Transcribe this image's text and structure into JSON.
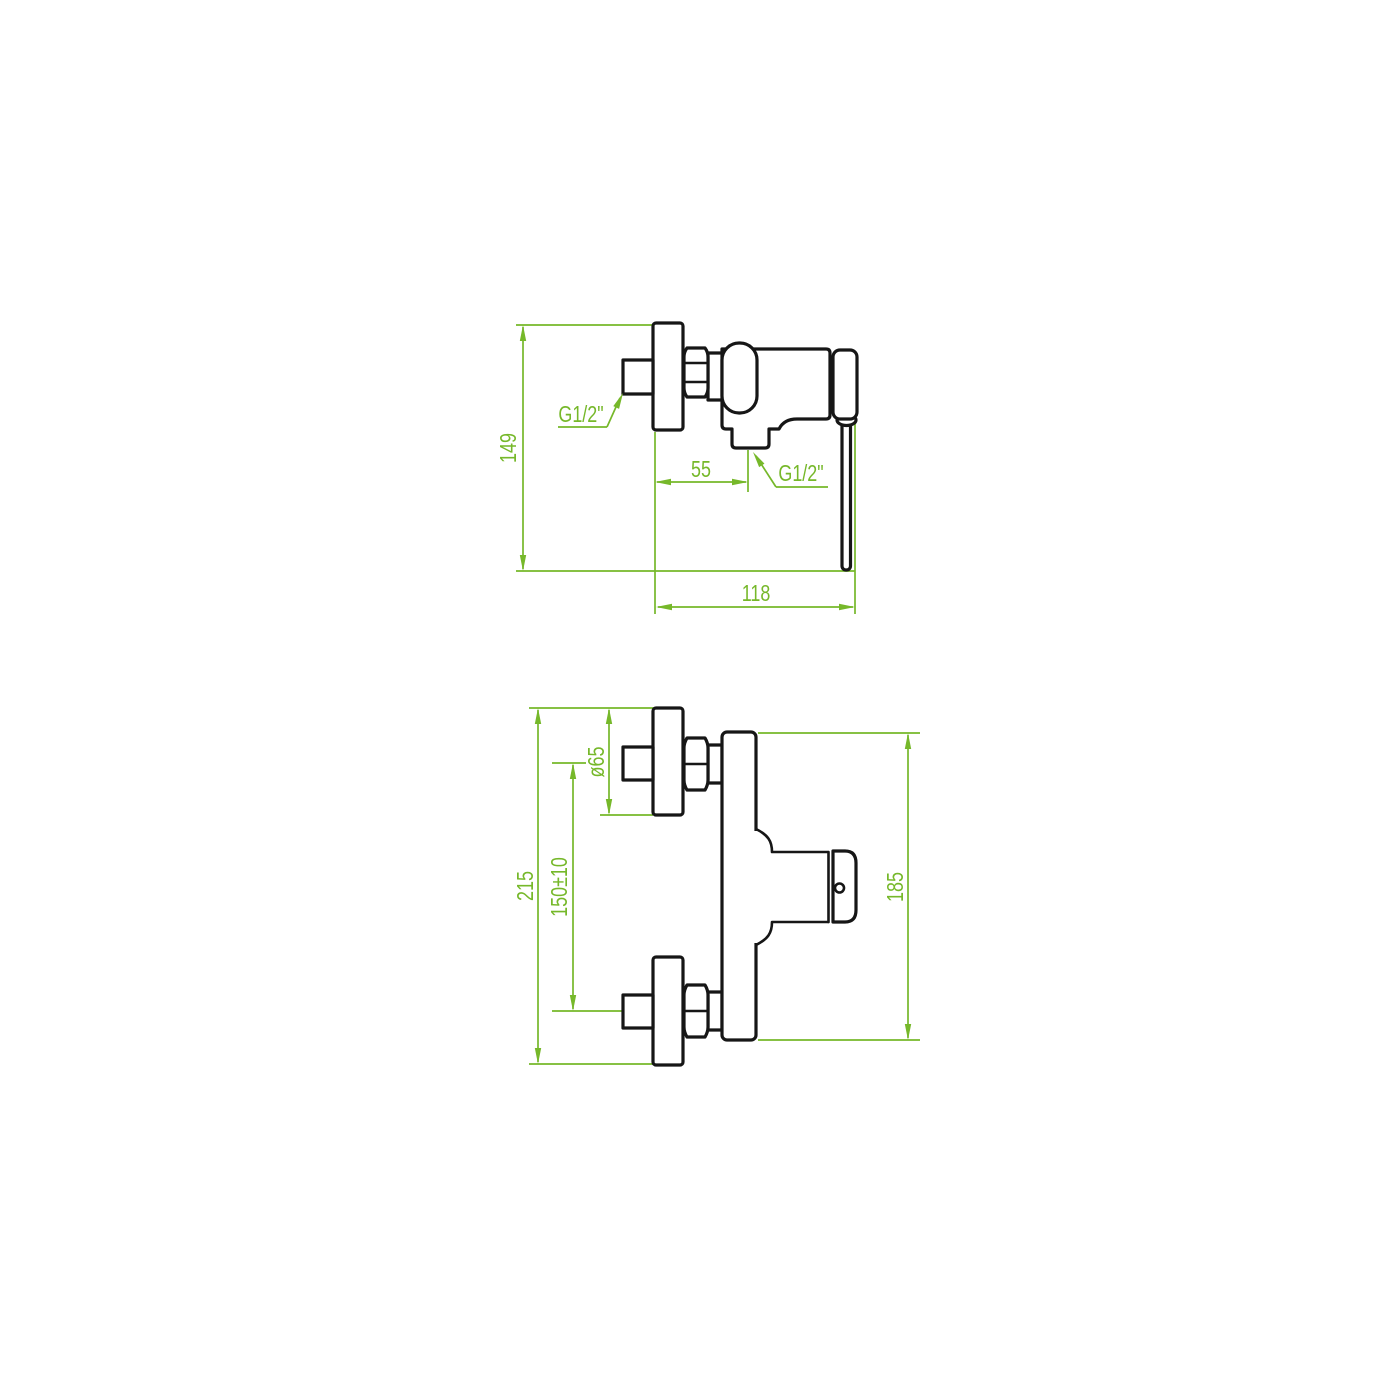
{
  "page": {
    "background": "#ffffff"
  },
  "drawing": {
    "type": "technical-dimension-drawing",
    "subject": "wall-mounted shower mixer tap",
    "part_line_color": "#161616",
    "dimension_color": "#76b82a",
    "views": {
      "side": {
        "label": "side-view",
        "dims": {
          "total_height": "149",
          "outlet_offset": "55",
          "total_depth": "118",
          "inlet_thread": "G1/2\"",
          "outlet_thread": "G1/2\""
        }
      },
      "front": {
        "label": "front-view",
        "dims": {
          "total_height": "215",
          "escutcheon_diameter": "ø65",
          "connection_spacing": "150±10",
          "body_height": "185"
        }
      }
    }
  }
}
